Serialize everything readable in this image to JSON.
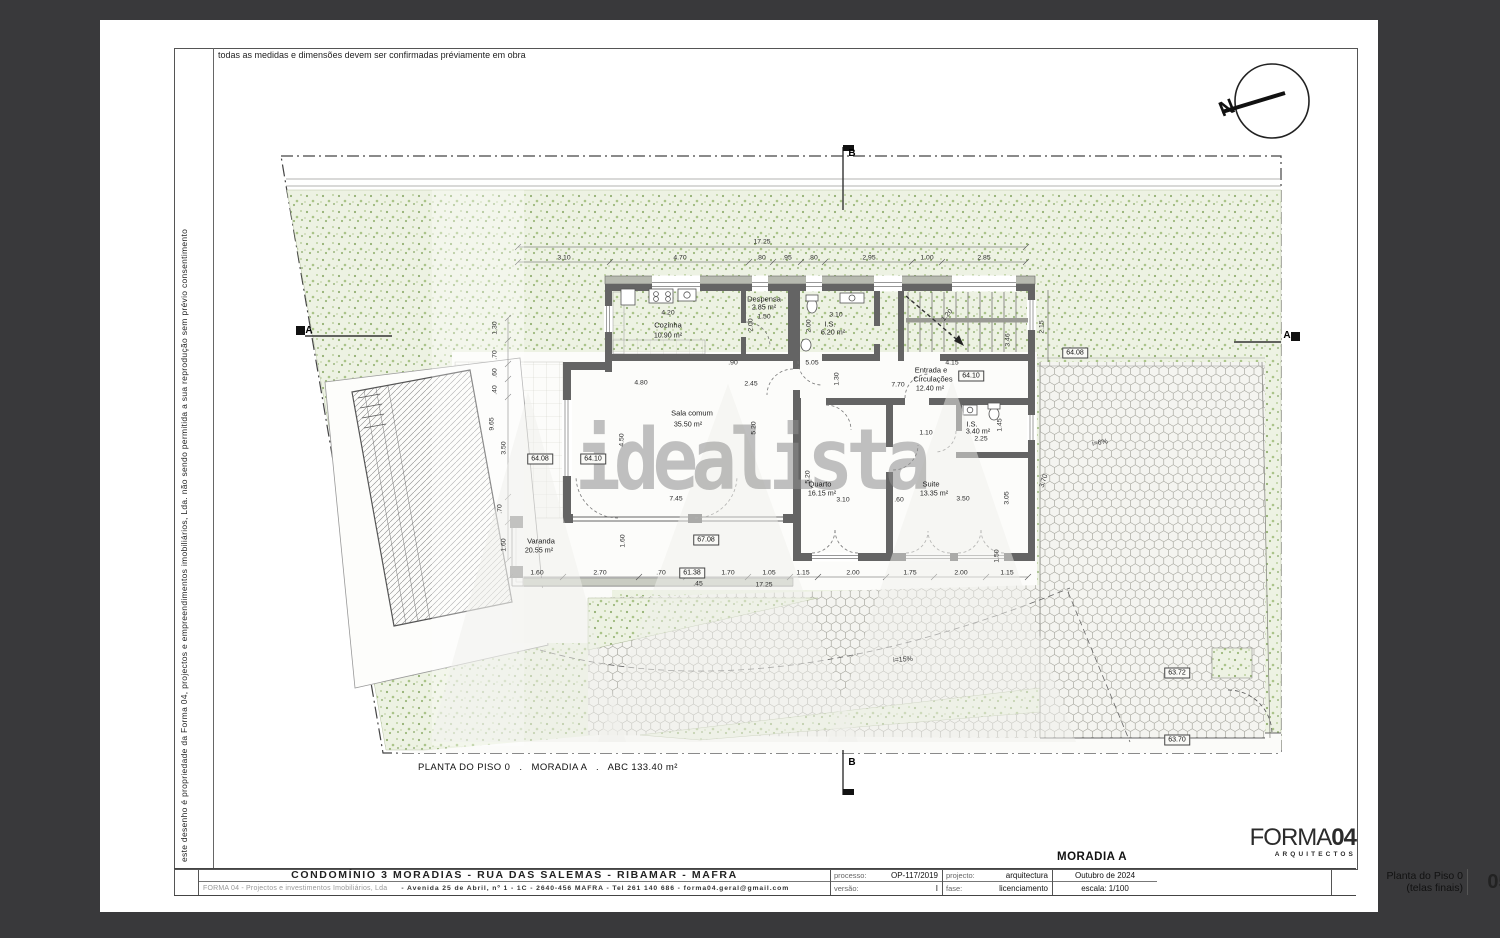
{
  "sheet": {
    "top_note": "todas as medidas e dimensões devem ser confirmadas préviamente em obra",
    "side_note": "este desenho é propriedade da Forma 04, projectos e empreendimentos imobiliários, Lda. não sendo permitida a sua reprodução sem prévio consentimento",
    "caption": "PLANTA DO PISO 0   .   MORADIA A   .   ABC 133.40 m²",
    "watermark": "idealista"
  },
  "title_block": {
    "project_title": "CONDOMÍNIO 3 MORADIAS - RUA DAS SALEMAS - RIBAMAR - MAFRA",
    "company": "FORMA 04 -  Projectos e investimentos Imobiliários, Lda",
    "address": "- Avenida 25 de Abril, nº 1 - 1C  -  2640-456  MAFRA  -  Tel  261 140 686  -  forma04.geral@gmail.com",
    "processo_label": "processo:",
    "processo": "OP-117/2019",
    "versao_label": "versão:",
    "versao": "I",
    "projecto_label": "projecto:",
    "projecto": "arquitectura",
    "fase_label": "fase:",
    "fase": "licenciamento",
    "date": "Outubro de 2024",
    "escala": "escala: 1/100",
    "moradia": "MORADIA A",
    "logo_forma": "FORMA",
    "logo_04": "04",
    "logo_sub": "ARQUITECTOS",
    "sheet_title_line1": "Planta do Piso 0",
    "sheet_title_line2": "(telas finais)",
    "sheet_number": "05"
  },
  "plan": {
    "labels": [
      {
        "k": "room",
        "t": "Cozinha",
        "x": 668,
        "y": 325
      },
      {
        "k": "area",
        "t": "10.90 m²",
        "x": 668,
        "y": 335
      },
      {
        "k": "dim",
        "t": "4.20",
        "x": 668,
        "y": 314
      },
      {
        "k": "room",
        "t": "Despensa",
        "x": 764,
        "y": 299
      },
      {
        "k": "area",
        "t": "2.85 m²",
        "x": 764,
        "y": 307
      },
      {
        "k": "dim",
        "t": "1.50",
        "x": 764,
        "y": 318
      },
      {
        "k": "dimv",
        "t": "2.00",
        "x": 752,
        "y": 325
      },
      {
        "k": "dim",
        "t": "3.10",
        "x": 836,
        "y": 316
      },
      {
        "k": "room",
        "t": "I.S.",
        "x": 830,
        "y": 324
      },
      {
        "k": "area",
        "t": "6.20 m²",
        "x": 833,
        "y": 332
      },
      {
        "k": "dimv",
        "t": "2.00",
        "x": 810,
        "y": 326
      },
      {
        "k": "dim",
        "t": ".90",
        "x": 733,
        "y": 364
      },
      {
        "k": "dim",
        "t": "5.05",
        "x": 812,
        "y": 364
      },
      {
        "k": "dim",
        "t": "4.15",
        "x": 952,
        "y": 364
      },
      {
        "k": "dimv",
        "t": "1.30",
        "x": 838,
        "y": 379
      },
      {
        "k": "room",
        "t": "Entrada e",
        "x": 931,
        "y": 370
      },
      {
        "k": "room",
        "t": "Circulações",
        "x": 933,
        "y": 379
      },
      {
        "k": "area",
        "t": "12.40 m²",
        "x": 930,
        "y": 388
      },
      {
        "k": "level",
        "t": "64.10",
        "x": 971,
        "y": 376
      },
      {
        "k": "dim",
        "t": "7.70",
        "x": 898,
        "y": 386
      },
      {
        "k": "dim",
        "t": "4.80",
        "x": 641,
        "y": 384
      },
      {
        "k": "dim",
        "t": "2.45",
        "x": 751,
        "y": 385
      },
      {
        "k": "room",
        "t": "Sala comum",
        "x": 692,
        "y": 413
      },
      {
        "k": "area",
        "t": "35.50 m²",
        "x": 688,
        "y": 424
      },
      {
        "k": "dimv",
        "t": "5.20",
        "x": 755,
        "y": 428
      },
      {
        "k": "dimv",
        "t": "4.50",
        "x": 623,
        "y": 440
      },
      {
        "k": "level",
        "t": "64.08",
        "x": 540,
        "y": 459
      },
      {
        "k": "level",
        "t": "64.10",
        "x": 593,
        "y": 459
      },
      {
        "k": "dim",
        "t": "7.45",
        "x": 676,
        "y": 500
      },
      {
        "k": "room",
        "t": "Quarto",
        "x": 820,
        "y": 484
      },
      {
        "k": "area",
        "t": "16.15 m²",
        "x": 822,
        "y": 493
      },
      {
        "k": "dimv",
        "t": "5.20",
        "x": 809,
        "y": 477
      },
      {
        "k": "dim",
        "t": "3.10",
        "x": 843,
        "y": 501
      },
      {
        "k": "dim",
        "t": ".60",
        "x": 899,
        "y": 501
      },
      {
        "k": "room",
        "t": "Suite",
        "x": 931,
        "y": 484
      },
      {
        "k": "area",
        "t": "13.35 m²",
        "x": 934,
        "y": 493
      },
      {
        "k": "dim",
        "t": "3.50",
        "x": 963,
        "y": 500
      },
      {
        "k": "dimv",
        "t": "3.05",
        "x": 1008,
        "y": 498
      },
      {
        "k": "room",
        "t": "I.S.",
        "x": 972,
        "y": 424
      },
      {
        "k": "area",
        "t": "3.40 m²",
        "x": 978,
        "y": 431
      },
      {
        "k": "dim",
        "t": "1.10",
        "x": 926,
        "y": 434
      },
      {
        "k": "dim",
        "t": "2.25",
        "x": 981,
        "y": 440
      },
      {
        "k": "dimv",
        "t": "1.45",
        "x": 1001,
        "y": 425
      },
      {
        "k": "dimv",
        "t": "1.50",
        "x": 998,
        "y": 556
      },
      {
        "k": "room",
        "t": "Varanda",
        "x": 541,
        "y": 541
      },
      {
        "k": "area",
        "t": "20.55 m²",
        "x": 539,
        "y": 550
      },
      {
        "k": "level",
        "t": "67.08",
        "x": 706,
        "y": 540
      },
      {
        "k": "dimv",
        "t": "1.60",
        "x": 624,
        "y": 541
      },
      {
        "k": "dimv",
        "t": "2.15",
        "x": 1043,
        "y": 327
      },
      {
        "k": "dimv",
        "t": "3.46",
        "x": 1009,
        "y": 340
      },
      {
        "k": "dim",
        "t": "1.20",
        "x": 948,
        "y": 316,
        "rot": -48
      },
      {
        "k": "slope",
        "t": "3.70",
        "x": 1044,
        "y": 481,
        "rot": -72
      },
      {
        "k": "level",
        "t": "64.08",
        "x": 1075,
        "y": 353
      },
      {
        "k": "slope",
        "t": "i=6%",
        "x": 1100,
        "y": 443,
        "rot": -10
      },
      {
        "k": "slope",
        "t": "i=15%",
        "x": 903,
        "y": 660,
        "rot": -4
      },
      {
        "k": "level",
        "t": "63.72",
        "x": 1177,
        "y": 673
      },
      {
        "k": "level",
        "t": "63.70",
        "x": 1177,
        "y": 740
      },
      {
        "k": "level",
        "t": "61.38",
        "x": 692,
        "y": 573
      },
      {
        "k": "dim",
        "t": ".45",
        "x": 698,
        "y": 585
      },
      {
        "k": "dim",
        "t": "17.25",
        "x": 764,
        "y": 586
      },
      {
        "k": "dim",
        "t": "17.25",
        "x": 762,
        "y": 243
      },
      {
        "k": "dim",
        "t": "3.10",
        "x": 564,
        "y": 259
      },
      {
        "k": "dim",
        "t": "4.70",
        "x": 680,
        "y": 259
      },
      {
        "k": "dim",
        "t": ".80",
        "x": 761,
        "y": 259
      },
      {
        "k": "dim",
        "t": ".95",
        "x": 787,
        "y": 259
      },
      {
        "k": "dim",
        "t": ".80",
        "x": 813,
        "y": 259
      },
      {
        "k": "dim",
        "t": "2.95",
        "x": 869,
        "y": 259
      },
      {
        "k": "dim",
        "t": "1.00",
        "x": 927,
        "y": 259
      },
      {
        "k": "dim",
        "t": "2.85",
        "x": 984,
        "y": 259
      },
      {
        "k": "dim",
        "t": "1.60",
        "x": 537,
        "y": 574
      },
      {
        "k": "dim",
        "t": "2.70",
        "x": 600,
        "y": 574
      },
      {
        "k": "dim",
        "t": ".70",
        "x": 661,
        "y": 574
      },
      {
        "k": "dim",
        "t": "1.70",
        "x": 728,
        "y": 574
      },
      {
        "k": "dim",
        "t": "1.05",
        "x": 769,
        "y": 574
      },
      {
        "k": "dim",
        "t": "1.15",
        "x": 803,
        "y": 574
      },
      {
        "k": "dim",
        "t": "2.00",
        "x": 853,
        "y": 574
      },
      {
        "k": "dim",
        "t": "1.75",
        "x": 910,
        "y": 574
      },
      {
        "k": "dim",
        "t": "2.00",
        "x": 961,
        "y": 574
      },
      {
        "k": "dim",
        "t": "1.15",
        "x": 1007,
        "y": 574
      },
      {
        "k": "dimv",
        "t": "1.30",
        "x": 496,
        "y": 328
      },
      {
        "k": "dimv",
        "t": ".70",
        "x": 496,
        "y": 355
      },
      {
        "k": "dimv",
        "t": ".60",
        "x": 496,
        "y": 373
      },
      {
        "k": "dimv",
        "t": ".40",
        "x": 496,
        "y": 390
      },
      {
        "k": "dimv",
        "t": "9.65",
        "x": 493,
        "y": 424
      },
      {
        "k": "dimv",
        "t": "3.50",
        "x": 505,
        "y": 448
      },
      {
        "k": "dimv",
        "t": ".70",
        "x": 501,
        "y": 509
      },
      {
        "k": "dimv",
        "t": "1.60",
        "x": 505,
        "y": 545
      },
      {
        "k": "marker",
        "t": "A",
        "x": 309,
        "y": 331
      },
      {
        "k": "marker",
        "t": "A",
        "x": 1287,
        "y": 336
      },
      {
        "k": "marker",
        "t": "B",
        "x": 852,
        "y": 154
      },
      {
        "k": "marker",
        "t": "B",
        "x": 852,
        "y": 763
      },
      {
        "k": "north",
        "t": "N",
        "x": 1227,
        "y": 108,
        "rot": -22
      }
    ]
  }
}
